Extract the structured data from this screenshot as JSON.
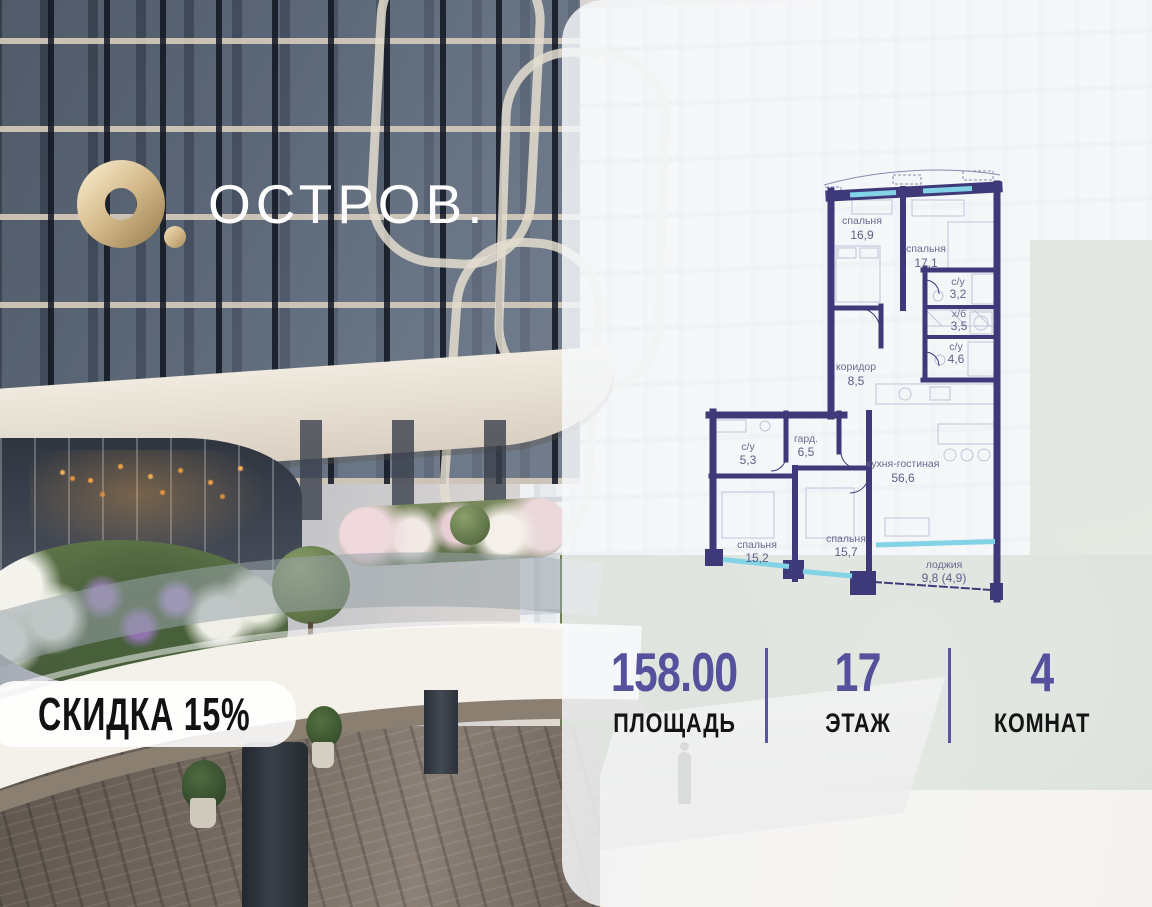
{
  "logo": {
    "brand": "ОСТРОВ."
  },
  "badge": {
    "label": "СКИДКА 15%"
  },
  "floorplan": {
    "rooms": [
      {
        "name": "спальня",
        "area": "16,9"
      },
      {
        "name": "спальня",
        "area": "17,1"
      },
      {
        "name": "с/у",
        "area": "3,2"
      },
      {
        "name": "х/б",
        "area": "3,5"
      },
      {
        "name": "с/у",
        "area": "4,6"
      },
      {
        "name": "коридор",
        "area": "8,5"
      },
      {
        "name": "с/у",
        "area": "5,3"
      },
      {
        "name": "гард.",
        "area": "6,5"
      },
      {
        "name": "кухня-гостиная",
        "area": "56,6"
      },
      {
        "name": "спальня",
        "area": "15,2"
      },
      {
        "name": "спальня",
        "area": "15,7"
      },
      {
        "name": "лоджия",
        "area": "9,8 (4,9)"
      }
    ]
  },
  "stats": {
    "items": [
      {
        "value": "158.00",
        "label": "ПЛОЩАДЬ"
      },
      {
        "value": "17",
        "label": "ЭТАЖ"
      },
      {
        "value": "4",
        "label": "КОМНАТ"
      }
    ]
  },
  "colors": {
    "accent": "#56519c",
    "wall": "#3e3a7a",
    "window": "#82d3e6",
    "gold": "#c9ab79"
  }
}
